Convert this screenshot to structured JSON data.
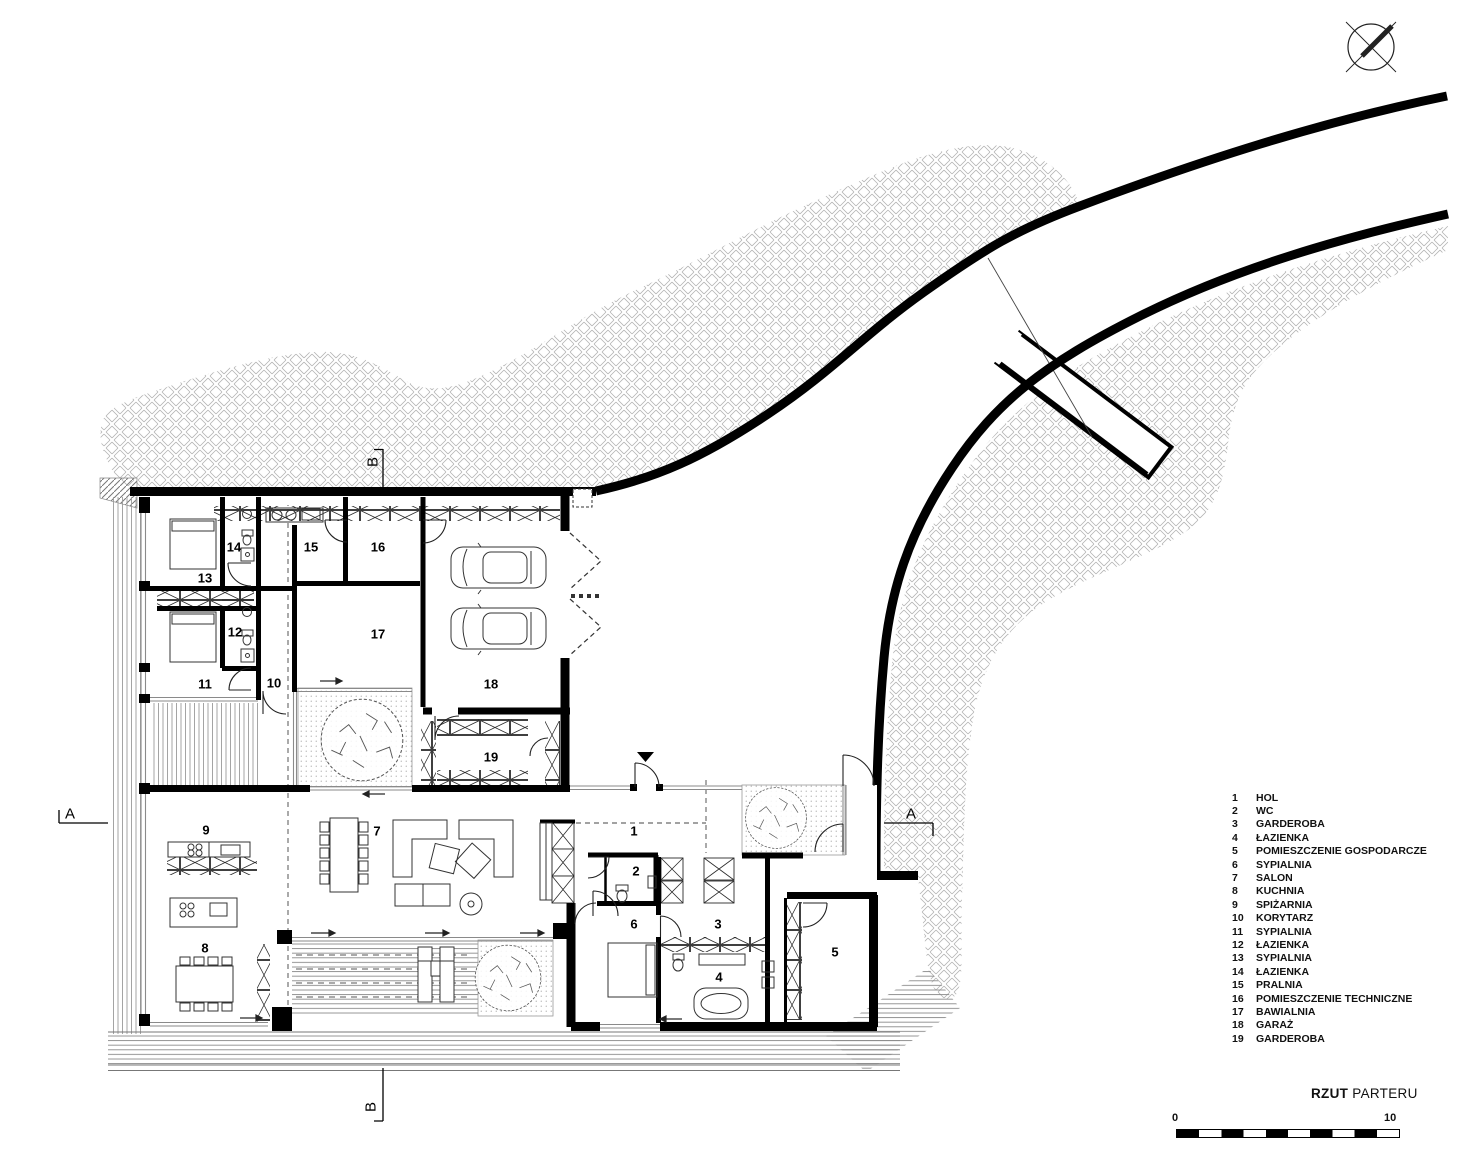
{
  "title": {
    "main": "RZUT",
    "sub": "PARTERU"
  },
  "scale": {
    "start": "0",
    "end": "10"
  },
  "sections": {
    "a": "A",
    "b": "B"
  },
  "icons": {
    "north_arrow": "north-arrow-compass-icon",
    "entrance": "entrance-direction-triangle-icon"
  },
  "rooms": [
    {
      "number": "1",
      "name": "HOL"
    },
    {
      "number": "2",
      "name": "WC"
    },
    {
      "number": "3",
      "name": "GARDEROBA"
    },
    {
      "number": "4",
      "name": "ŁAZIENKA"
    },
    {
      "number": "5",
      "name": "POMIESZCZENIE GOSPODARCZE"
    },
    {
      "number": "6",
      "name": "SYPIALNIA"
    },
    {
      "number": "7",
      "name": "SALON"
    },
    {
      "number": "8",
      "name": "KUCHNIA"
    },
    {
      "number": "9",
      "name": "SPIŻARNIA"
    },
    {
      "number": "10",
      "name": "KORYTARZ"
    },
    {
      "number": "11",
      "name": "SYPIALNIA"
    },
    {
      "number": "12",
      "name": "ŁAZIENKA"
    },
    {
      "number": "13",
      "name": "SYPIALNIA"
    },
    {
      "number": "14",
      "name": "ŁAZIENKA"
    },
    {
      "number": "15",
      "name": "PRALNIA"
    },
    {
      "number": "16",
      "name": "POMIESZCZENIE TECHNICZNE"
    },
    {
      "number": "17",
      "name": "BAWIALNIA"
    },
    {
      "number": "18",
      "name": "GARAŻ"
    },
    {
      "number": "19",
      "name": "GARDEROBA"
    }
  ],
  "colors": {
    "ink": "#000000",
    "hatch": "#b3b3b3",
    "window": "#8a8a8a"
  }
}
